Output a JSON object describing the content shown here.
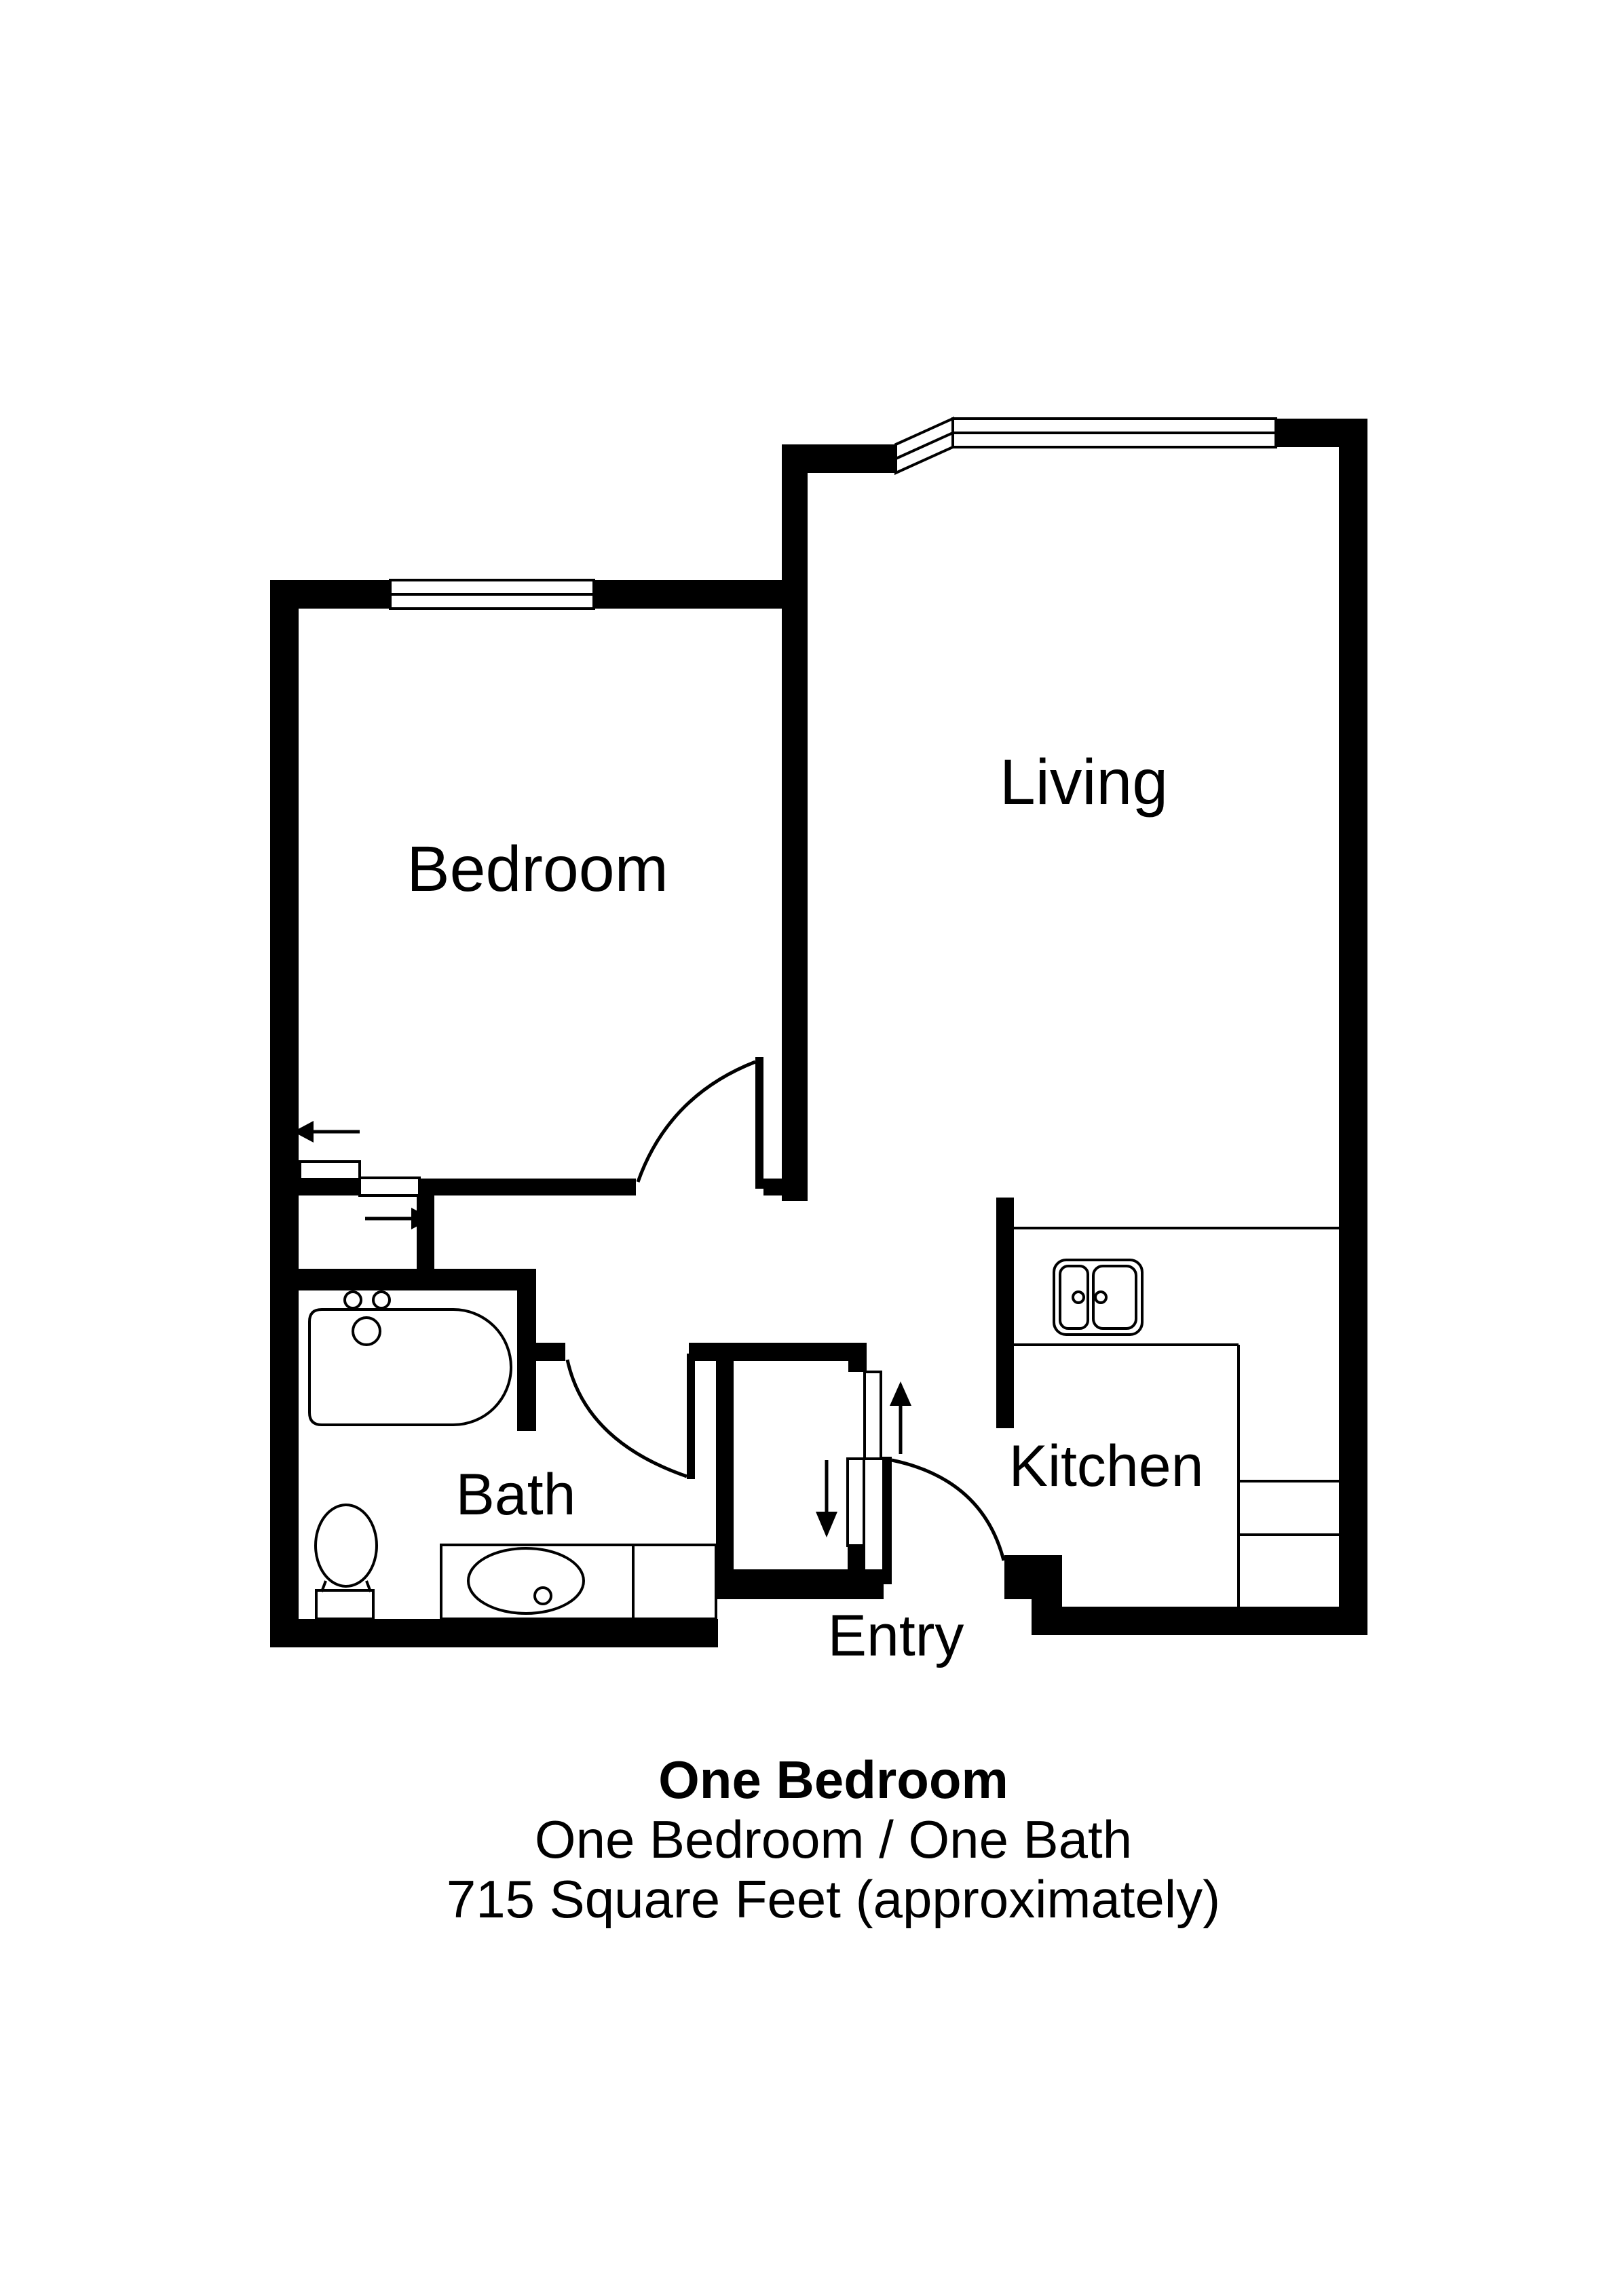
{
  "title": "One Bedroom floor plan",
  "colors": {
    "wall": "#000000",
    "background": "#ffffff",
    "line": "#000000"
  },
  "rooms": {
    "bedroom": "Bedroom",
    "living": "Living",
    "bath": "Bath",
    "kitchen": "Kitchen",
    "entry": "Entry"
  },
  "caption": {
    "line1": "One Bedroom",
    "line2": "One Bedroom / One Bath",
    "line3": "715 Square Feet (approximately)"
  },
  "icons": {
    "bathtub": "bathtub-icon",
    "toilet": "toilet-icon",
    "vanity_sink": "vanity-sink-icon",
    "kitchen_sink": "double-kitchen-sink-icon",
    "windows": [
      "bedroom-window",
      "living-bay-diagonal-window",
      "living-top-window"
    ],
    "doors": [
      "bedroom-door",
      "bath-door",
      "entry-door"
    ],
    "sliding_doors": [
      "bedroom-closet-bypass-doors",
      "entry-closet-bypass-doors"
    ],
    "arrows": [
      "slide-left-arrow",
      "slide-right-arrow",
      "slide-up-arrow",
      "slide-down-arrow"
    ]
  }
}
